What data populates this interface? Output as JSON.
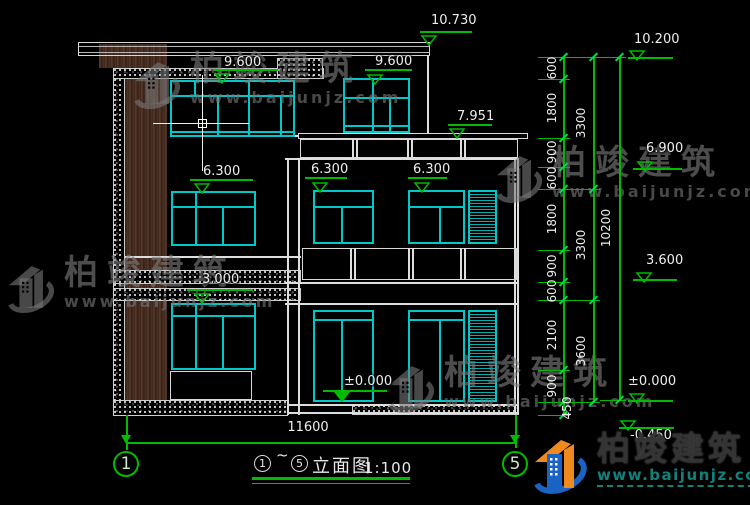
{
  "colors": {
    "cyan": "#00c8c8",
    "green": "#00bb00",
    "line_white": "#dedede",
    "wood_brown": "#4a2e1f",
    "watermark_gray": "#7d7d7d",
    "logo_blue": "#1a63c4",
    "logo_orange": "#f08a1e",
    "logo_teal": "#13807a"
  },
  "levels": [
    {
      "label": "10.730",
      "tx": 431,
      "ty": 14,
      "bx": 420,
      "bw": 52,
      "by": 31,
      "ax": 429,
      "ay": 42,
      "filled": false
    },
    {
      "label": "9.600",
      "tx": 224,
      "ty": 56,
      "bx": 213,
      "bw": 65,
      "by": 69,
      "ax": 222,
      "ay": 80,
      "filled": false
    },
    {
      "label": "9.600",
      "tx": 375,
      "ty": 55,
      "bx": 365,
      "bw": 47,
      "by": 69,
      "ax": 375,
      "ay": 81,
      "filled": false
    },
    {
      "label": "7.951",
      "tx": 457,
      "ty": 110,
      "bx": 448,
      "bw": 44,
      "by": 124,
      "ax": 457,
      "ay": 135,
      "filled": false
    },
    {
      "label": "6.300",
      "tx": 203,
      "ty": 165,
      "bx": 190,
      "bw": 63,
      "by": 179,
      "ax": 202,
      "ay": 190,
      "filled": false
    },
    {
      "label": "6.300",
      "tx": 311,
      "ty": 163,
      "bx": 305,
      "bw": 42,
      "by": 177,
      "ax": 320,
      "ay": 189,
      "filled": false
    },
    {
      "label": "6.300",
      "tx": 413,
      "ty": 163,
      "bx": 408,
      "bw": 39,
      "by": 177,
      "ax": 422,
      "ay": 189,
      "filled": false
    },
    {
      "label": "3.000",
      "tx": 202,
      "ty": 273,
      "bx": 187,
      "bw": 66,
      "by": 289,
      "ax": 202,
      "ay": 300,
      "filled": false
    },
    {
      "label": "±0.000",
      "tx": 344,
      "ty": 375,
      "bx": 323,
      "bw": 64,
      "by": 390,
      "ax": 342,
      "ay": 398,
      "filled": true
    },
    {
      "label": "10.200",
      "tx": 634,
      "ty": 33,
      "bx": 628,
      "bw": 45,
      "by": 57,
      "ax": 637,
      "ay": 57,
      "filled": false
    },
    {
      "label": "6.900",
      "tx": 646,
      "ty": 142,
      "bx": 633,
      "bw": 49,
      "by": 168,
      "ax": 645,
      "ay": 168,
      "filled": false
    },
    {
      "label": "3.600",
      "tx": 646,
      "ty": 254,
      "bx": 633,
      "bw": 44,
      "by": 279,
      "ax": 644,
      "ay": 279,
      "filled": false
    },
    {
      "label": "±0.000",
      "tx": 628,
      "ty": 375,
      "bx": 628,
      "bw": 45,
      "by": 400,
      "ax": 637,
      "ay": 400,
      "filled": false
    },
    {
      "label": "-0.450",
      "tx": 630,
      "ty": 429,
      "bx": 619,
      "bw": 55,
      "by": 427,
      "ax": 628,
      "ay": 427,
      "filled": false
    }
  ],
  "right_dim_chain": {
    "lines": [
      {
        "x": 563,
        "y1": 57,
        "y2": 415
      },
      {
        "x": 593,
        "y1": 57,
        "y2": 402
      },
      {
        "x": 619,
        "y1": 57,
        "y2": 400
      }
    ],
    "ticks": [
      {
        "x": 563,
        "ys": [
          57,
          79,
          138,
          167,
          189,
          250,
          282,
          300,
          370,
          402,
          415
        ]
      },
      {
        "x": 593,
        "ys": [
          57,
          189,
          300,
          402
        ]
      },
      {
        "x": 619,
        "ys": [
          57,
          400
        ]
      }
    ],
    "ext_lines": [
      {
        "x1": 538,
        "x2": 570,
        "ys": [
          57,
          79,
          138,
          167,
          189,
          250,
          282,
          300,
          370,
          402,
          415
        ]
      },
      {
        "x1": 570,
        "x2": 600,
        "ys": [
          57,
          189,
          300,
          402
        ]
      },
      {
        "x1": 600,
        "x2": 626,
        "ys": [
          57,
          400
        ]
      }
    ],
    "labels": [
      {
        "text": "600",
        "x": 552,
        "y": 68
      },
      {
        "text": "1800",
        "x": 552,
        "y": 108
      },
      {
        "text": "900",
        "x": 552,
        "y": 152
      },
      {
        "text": "600",
        "x": 552,
        "y": 178
      },
      {
        "text": "1800",
        "x": 552,
        "y": 219
      },
      {
        "text": "900",
        "x": 552,
        "y": 266
      },
      {
        "text": "600",
        "x": 552,
        "y": 291
      },
      {
        "text": "2100",
        "x": 552,
        "y": 335
      },
      {
        "text": "900",
        "x": 552,
        "y": 386
      },
      {
        "text": "450",
        "x": 567,
        "y": 408
      },
      {
        "text": "3300",
        "x": 581,
        "y": 123
      },
      {
        "text": "3300",
        "x": 581,
        "y": 245
      },
      {
        "text": "3600",
        "x": 581,
        "y": 351
      },
      {
        "text": "10200",
        "x": 606,
        "y": 228
      }
    ]
  },
  "bottom_dim": {
    "label": "11600",
    "x1": 126,
    "x2": 515,
    "y": 442,
    "text_x": 278,
    "text_y": 420
  },
  "grid_bubbles": [
    {
      "label": "1",
      "cx": 126,
      "cy": 464
    },
    {
      "label": "5",
      "cx": 515,
      "cy": 464
    }
  ],
  "leaders": [
    {
      "x": 126,
      "y1": 415,
      "y2": 450
    },
    {
      "x": 515,
      "y1": 415,
      "y2": 448
    }
  ],
  "title_block": {
    "circle_start": "1",
    "tilde": "~",
    "circle_end": "5",
    "name": "立面图",
    "scale": "1:100"
  },
  "watermark": {
    "brand": "柏竣建筑",
    "url": "www.baijunjz.com",
    "positions": [
      {
        "x": 128,
        "y": 52
      },
      {
        "x": 490,
        "y": 146
      },
      {
        "x": 2,
        "y": 256
      },
      {
        "x": 382,
        "y": 356
      }
    ]
  },
  "logo": {
    "brand": "柏竣建筑",
    "url": "www.baijunjz.com"
  }
}
